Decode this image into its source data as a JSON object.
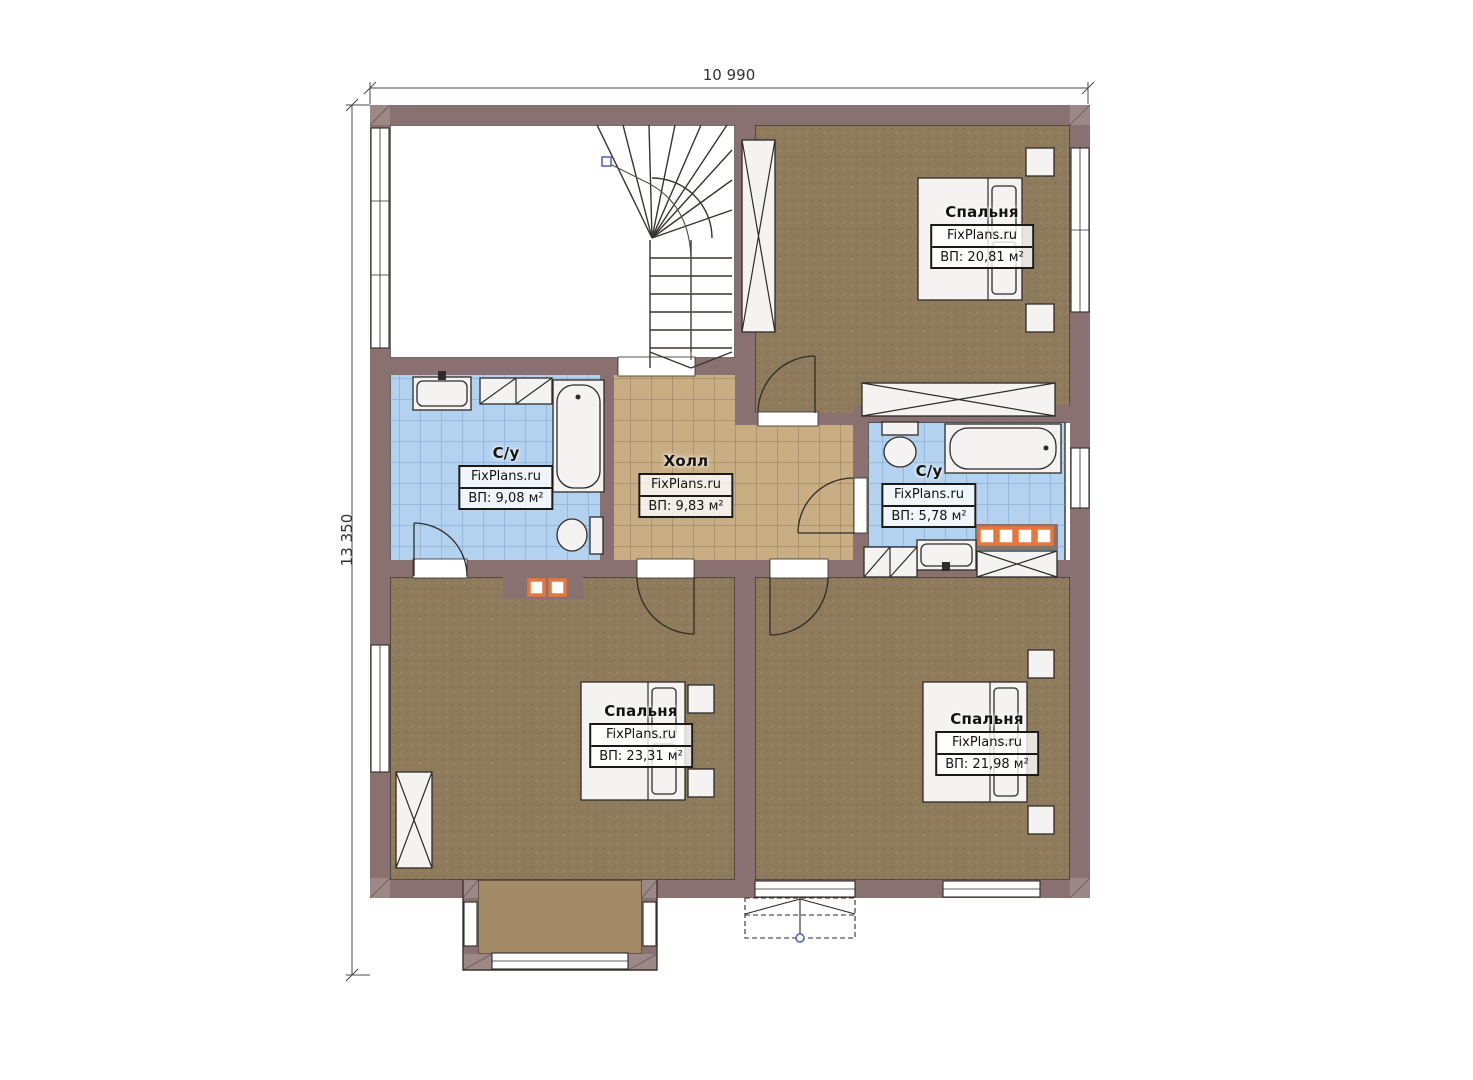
{
  "dimensions": {
    "top": "10 990",
    "left": "13 350"
  },
  "rooms": [
    {
      "key": "bedroom-top-right",
      "name": "Спальня",
      "brand": "FixPlans.ru",
      "area": "ВП: 20,81 м²"
    },
    {
      "key": "bathroom-left",
      "name": "С/у",
      "brand": "FixPlans.ru",
      "area": "ВП: 9,08 м²"
    },
    {
      "key": "hall",
      "name": "Холл",
      "brand": "FixPlans.ru",
      "area": "ВП: 9,83 м²"
    },
    {
      "key": "bathroom-right",
      "name": "С/у",
      "brand": "FixPlans.ru",
      "area": "ВП: 5,78 м²"
    },
    {
      "key": "bedroom-bottom-left",
      "name": "Спальня",
      "brand": "FixPlans.ru",
      "area": "ВП: 23,31 м²"
    },
    {
      "key": "bedroom-bottom-right",
      "name": "Спальня",
      "brand": "FixPlans.ru",
      "area": "ВП: 21,98 м²"
    }
  ],
  "colors": {
    "wall": "#8a7171",
    "wall_light": "#9d8888",
    "floor_bedroom": "#8e7b5c",
    "floor_hall": "#c9ae84",
    "floor_bath": "#b3d2ef",
    "floor_bay": "#a28b66",
    "tile_line_hall": "#8d7a58",
    "tile_line_bath": "#7aa3cc",
    "flue_orange": "#e8773b",
    "line": "#2f2b28"
  }
}
